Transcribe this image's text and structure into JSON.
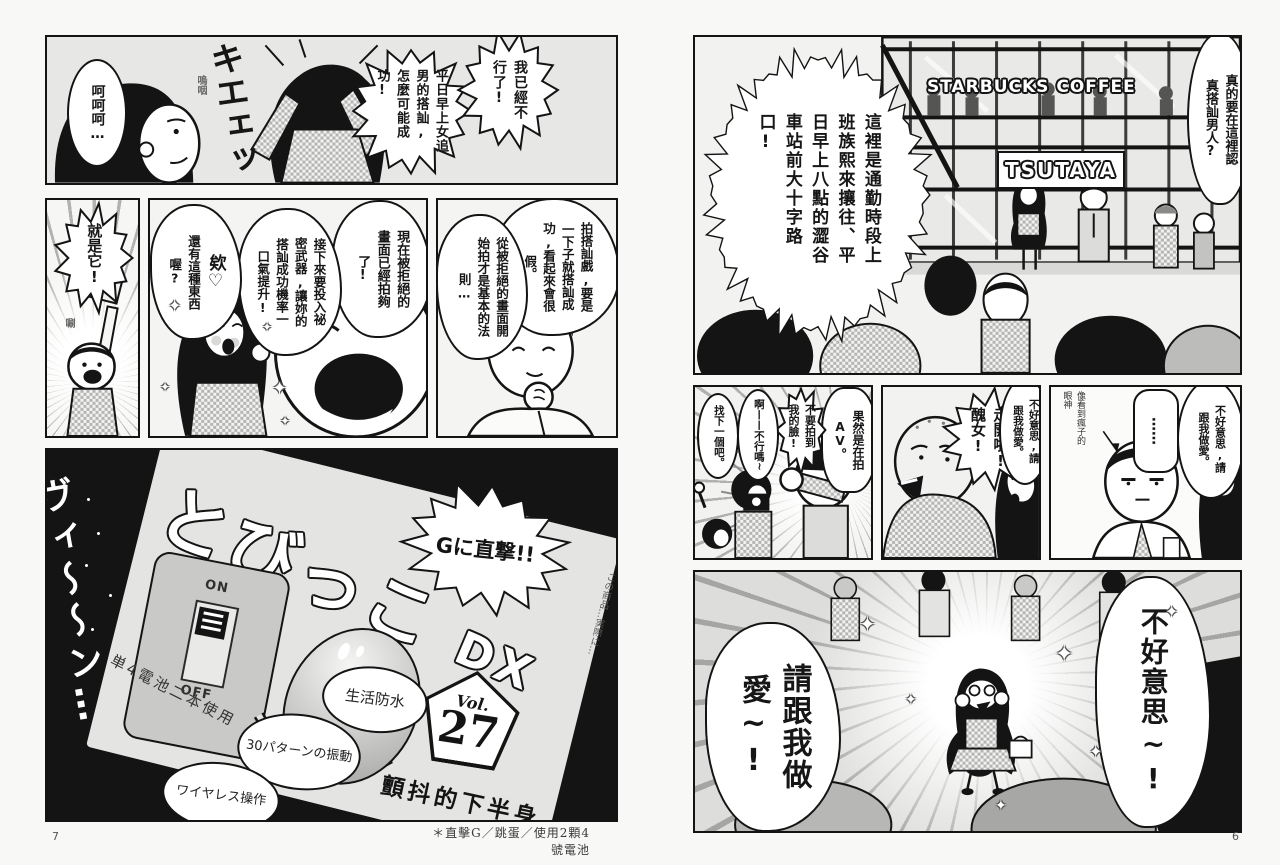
{
  "icons": {
    "sparkle": "✦"
  },
  "left_page": {
    "page_number": "7",
    "footnote": "＊直擊G／跳蛋／使用2顆4號電池",
    "panel_intro": {
      "laugh": "呵呵呵…",
      "sfx_big": "キエェッ",
      "sfx_small": "嗚咽",
      "bubble_give_up": "我已經不行了!",
      "bubble_impossible": "平日早上女追男的搭訕,怎麼可能成功!"
    },
    "panel_thats_it": {
      "shout": "就是它!",
      "sfx": "唰"
    },
    "panel_secret_weapon": {
      "bubble_enough": "現在被拒絕的畫面已經拍夠了!",
      "bubble_weapon": "接下來要投入祕密武器,讓妳的搭訕成功機率一口氣提升!",
      "bubble_eh": "欸♡",
      "bubble_such_thing": "還有這種東西喔?"
    },
    "panel_rule": {
      "bubble_fake": "拍搭訕戲,要是一下子就搭訕成功,看起來會很假。",
      "bubble_basic": "從被拒絕的畫面開始拍才是基本的法則…"
    },
    "panel_product": {
      "sfx": "ヴィ〜〜ン…",
      "burst": "Gに直撃!!",
      "name": "とびっこ",
      "name_suffix": "DX",
      "vol_label": "Vol.",
      "vol_number": "27",
      "features": [
        "生活防水",
        "30パターンの振動",
        "ワイヤレス操作"
      ],
      "battery_note": "単4電池二本使用",
      "switch_on": "ON",
      "switch_off": "OFF",
      "side_note": "この商品…実際に…",
      "episode_title": "顫抖的下半身"
    }
  },
  "right_page": {
    "page_number": "6",
    "panel_crossing": {
      "narration": "這裡是通勤時段上班族熙來攘往、平日早上八點的澀谷車站前大十字路口!",
      "bubble_really": "真的要在這裡認真搭訕男人?",
      "sign_starbucks": "STARBUCKS COFFEE",
      "sign_tsutaya": "TSUTAYA"
    },
    "panel_av": {
      "bubble_av": "果然是在拍AV。",
      "bubble_face": "不要拍到我的臉!",
      "bubble_no_good": "啊——不行嗎~",
      "bubble_next": "找下一個吧。"
    },
    "panel_ugly": {
      "bubble_go_away": "走開啦!醜女!",
      "bubble_excuse": "不好意思,請跟我做愛。"
    },
    "panel_stare": {
      "bubble_excuse": "不好意思,請跟我做愛。",
      "bubble_silence": "……",
      "note": "像看到瘋子的眼神"
    },
    "panel_plea": {
      "shout_excuse": "不好意思~!",
      "shout_love": "請跟我做愛~!"
    }
  }
}
